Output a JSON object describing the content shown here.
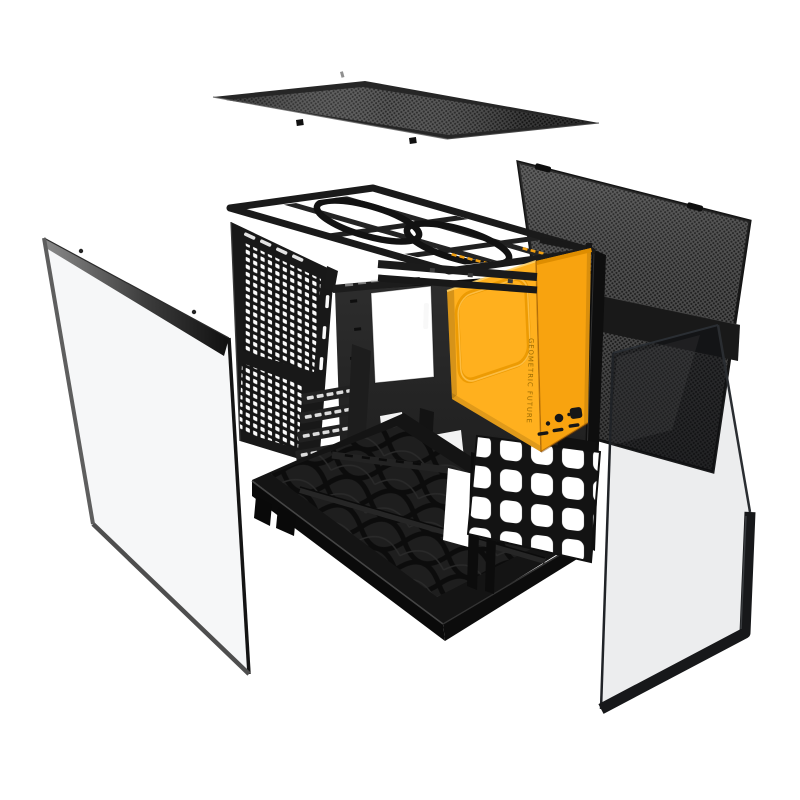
{
  "canvas": {
    "width": 800,
    "height": 800
  },
  "branding": {
    "logo_text": "GEOMETRIC FUTURE"
  },
  "colors": {
    "background": "#FFFFFF",
    "orange_side": "#FFB01E",
    "orange_front": "#F8A30F",
    "orange_deep": "#DE8D00",
    "orange_ring": "#ED9B03",
    "orange_ring_highlight": "#FFC654",
    "logo_text": "#9B6A00",
    "chassis_dark": "#181818",
    "mesh_base": "#4E4E4E",
    "mesh_dot": "#1B1B1B",
    "mesh_band": "#191919",
    "glass_frame": "#17181A"
  },
  "parts": {
    "top_mesh": "Top mesh panel",
    "rear_mesh": "Rear mesh panel",
    "chassis": "Chassis frame",
    "front_panel": "Front I/O panel (orange)",
    "left_glass": "Tempered glass side panel (left)",
    "right_glass": "Tempered glass panel (right)"
  }
}
